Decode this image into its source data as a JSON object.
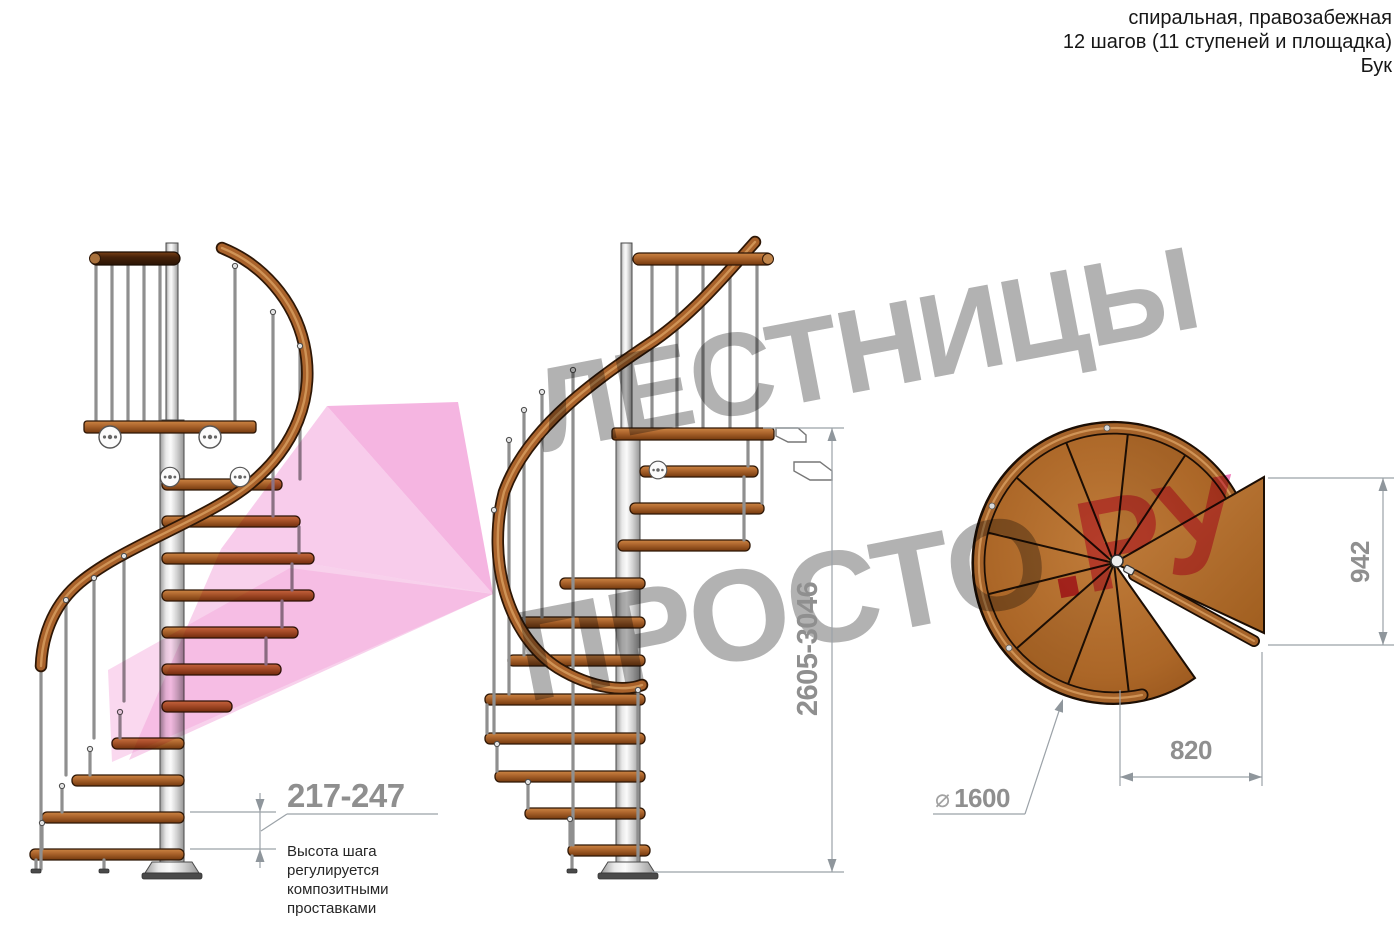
{
  "header": {
    "line1": "спиральная, правозабежная",
    "line2": "12 шагов (11 ступеней и площадка)",
    "line3": "Бук"
  },
  "watermark": {
    "word1": "ЛЕСТНИЦЫ",
    "word2": "ПРОСТО",
    "dot": ".",
    "suffix": "РУ"
  },
  "dimensions": {
    "step_height": "217-247",
    "step_height_note_lines": [
      "Высота шага",
      "регулируется",
      "композитными",
      "проставками"
    ],
    "total_height": "2605-3046",
    "landing_height": "942",
    "landing_width": "820",
    "diameter_symbol": "⌀",
    "diameter_value": "1600"
  },
  "colors": {
    "watermark_gray": "#b2b2b2",
    "watermark_pink": "#f07cba",
    "watermark_pink_dark": "#e04a87",
    "arrow_pink": "#f2a3da",
    "wood": "#a9622b",
    "wood_dark": "#46220a",
    "metal": "#d9d9d9",
    "dimension_gray": "#8f8f8f",
    "note_text": "#262626"
  }
}
